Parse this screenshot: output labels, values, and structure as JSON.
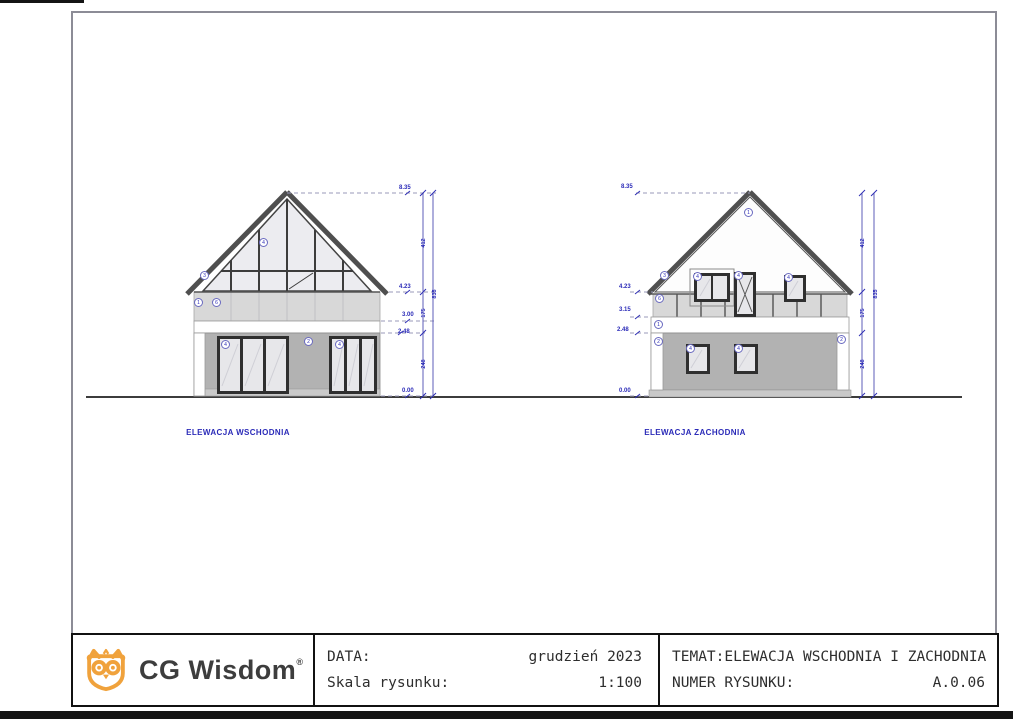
{
  "east": {
    "caption": "ELEWACJA WSCHODNIA",
    "levels": [
      "8.35",
      "4.23",
      "3.00",
      "2.48",
      "0.00"
    ],
    "chain": [
      "412",
      "175",
      "248"
    ],
    "overall": "835",
    "tags": [
      {
        "id": "roof",
        "label": "3"
      },
      {
        "id": "corner-wall",
        "label": "1"
      },
      {
        "id": "parapet-band",
        "label": "6"
      },
      {
        "id": "gable-glazing",
        "label": "4"
      },
      {
        "id": "ground-wall",
        "label": "2"
      },
      {
        "id": "door-left",
        "label": "4"
      },
      {
        "id": "door-right",
        "label": "4"
      }
    ]
  },
  "west": {
    "caption": "ELEWACJA ZACHODNIA",
    "levels": [
      "8.35",
      "4.23",
      "3.15",
      "2.48",
      "0.00"
    ],
    "chain": [
      "412",
      "175",
      "248"
    ],
    "overall": "835",
    "tags": [
      {
        "id": "gable-wall",
        "label": "1"
      },
      {
        "id": "roof",
        "label": "3"
      },
      {
        "id": "parapet-band",
        "label": "6"
      },
      {
        "id": "window-upper-left",
        "label": "4"
      },
      {
        "id": "balcony-door",
        "label": "4"
      },
      {
        "id": "window-upper-right",
        "label": "4"
      },
      {
        "id": "wall-strip",
        "label": "1"
      },
      {
        "id": "pilaster-left",
        "label": "2"
      },
      {
        "id": "pilaster-right",
        "label": "2"
      },
      {
        "id": "window-ground-left",
        "label": "4"
      },
      {
        "id": "window-ground-right",
        "label": "4"
      }
    ]
  },
  "title_block": {
    "logo_text": "CG Wisdom",
    "logo_reg": "®",
    "date_label": "DATA:",
    "date_value": "grudzień 2023",
    "scale_label": "Skala rysunku:",
    "scale_value": "1:100",
    "subject_label": "TEMAT:",
    "subject_value": "ELEWACJA WSCHODNIA I ZACHODNIA",
    "number_label": "NUMER RYSUNKU:",
    "number_value": "A.0.06"
  },
  "colors": {
    "annotation_blue": "#2b2bb8",
    "roof_gray": "#4f4f4f",
    "wall_gray": "#b2b2b2",
    "band_gray": "#d8d8d8",
    "logo_orange": "#F0A23C"
  }
}
